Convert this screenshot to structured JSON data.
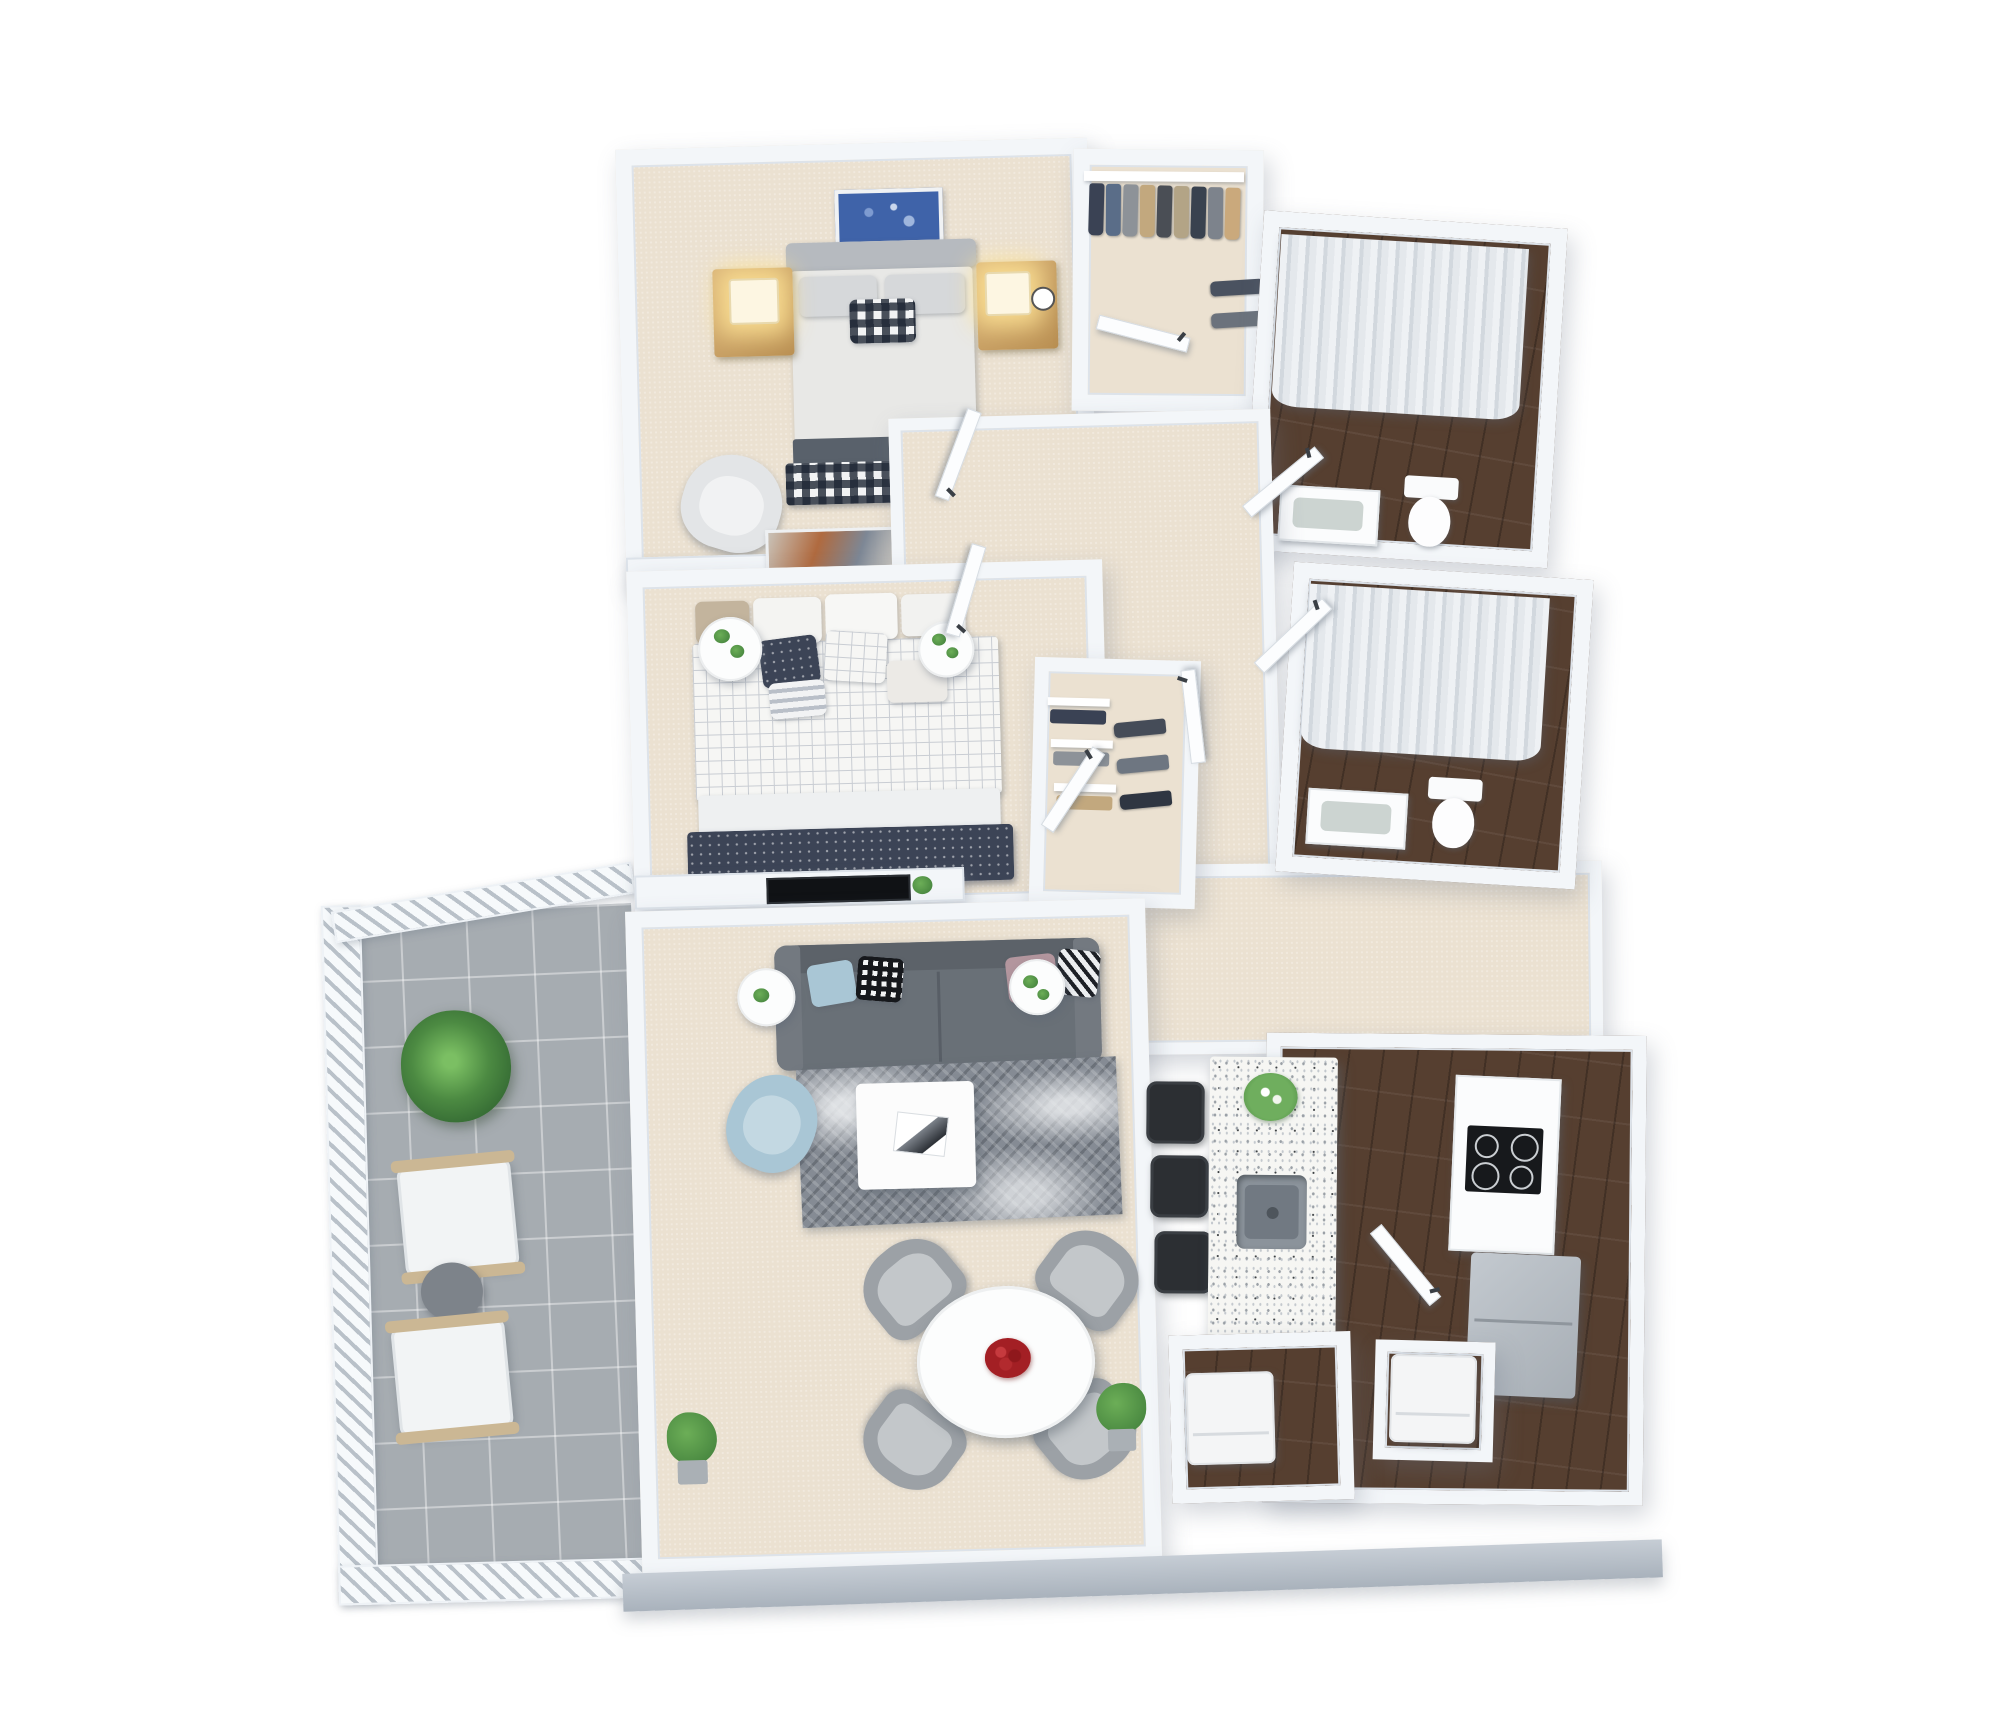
{
  "scene": {
    "type": "3d-floorplan-render",
    "title": "3D Floor Plan — Two-Bedroom Apartment",
    "view": "isometric top-down",
    "background": "#ffffff"
  },
  "colors": {
    "wall": "#f3f6f9",
    "wall-edge": "#dde3ea",
    "wall-face": "#b6bec7",
    "carpet": "#ebe1d1",
    "wood": "#563f30",
    "tile": "#a6acb1",
    "sofa": "#697077",
    "sofa-dark": "#5c6269",
    "rug": "#858b94",
    "navy": "#3c4456",
    "lightblue": "#a9c6d5",
    "gold": "#c89f63",
    "island": "#f6f6f3",
    "steel": "#8b939b",
    "black": "#26292d",
    "green": "#4c8a42",
    "red": "#a31f24",
    "curtain": "#e2e6eb",
    "graychair": "#9ca1a6",
    "bedgray": "#e8e8e6",
    "headboard": "#b6babf"
  },
  "rooms": [
    {
      "name": "Master Bedroom",
      "floor": "beige carpet",
      "furniture": [
        "queen bed with gray headboard and gingham accent pillow",
        "blue abstract wall art",
        "gold nightstand with lit lamp (left)",
        "gold nightstand with lit lamp and clock (right)",
        "gray accent armchair",
        "media console with leaning artwork and TV"
      ]
    },
    {
      "name": "Walk-in Closet",
      "floor": "beige carpet",
      "furniture": [
        "hanging rod with jackets, jeans and khakis",
        "side hanging rod"
      ]
    },
    {
      "name": "Bathroom 1",
      "floor": "dark wood",
      "furniture": [
        "walk-in shower with white curtain",
        "vanity with sink",
        "toilet"
      ]
    },
    {
      "name": "Hallway",
      "floor": "beige carpet",
      "furniture": [
        "white hinged doors with black handles"
      ]
    },
    {
      "name": "Bedroom 2",
      "floor": "beige carpet",
      "furniture": [
        "bed with white grid duvet and navy dotted throw",
        "round side table with plants (left)",
        "round side table with plants (right)",
        "wall-mounted TV",
        "reach-in closet with shelves and hanging clothes"
      ]
    },
    {
      "name": "Bedroom 2 Closet",
      "floor": "beige carpet",
      "furniture": [
        "folded clothes shelves",
        "hanging clothes"
      ]
    },
    {
      "name": "Bathroom 2",
      "floor": "dark wood",
      "furniture": [
        "walk-in shower with white curtain",
        "vanity with sink",
        "toilet"
      ]
    },
    {
      "name": "Living Room",
      "floor": "beige carpet",
      "furniture": [
        "gray 3-seat sofa with throw pillows",
        "two round white side tables with plants",
        "gray patterned area rug",
        "white square coffee table with magazine",
        "light blue accent armchair",
        "two potted floor plants"
      ]
    },
    {
      "name": "Dining Area",
      "floor": "beige carpet",
      "furniture": [
        "round white dining table with red flower centerpiece",
        "four gray dining chairs"
      ]
    },
    {
      "name": "Kitchen",
      "floor": "dark wood",
      "furniture": [
        "terrazzo island with stainless sink and white flowers",
        "three black bar stools",
        "counter with black 4-burner cooktop",
        "gray refrigerator / cabinets"
      ]
    },
    {
      "name": "Laundry",
      "floor": "dark wood",
      "furniture": [
        "washer",
        "dryer"
      ]
    },
    {
      "name": "Balcony",
      "floor": "gray tile",
      "furniture": [
        "white slatted railing",
        "large potted plant",
        "two white lounge chairs",
        "round dark-gray side table"
      ]
    }
  ]
}
